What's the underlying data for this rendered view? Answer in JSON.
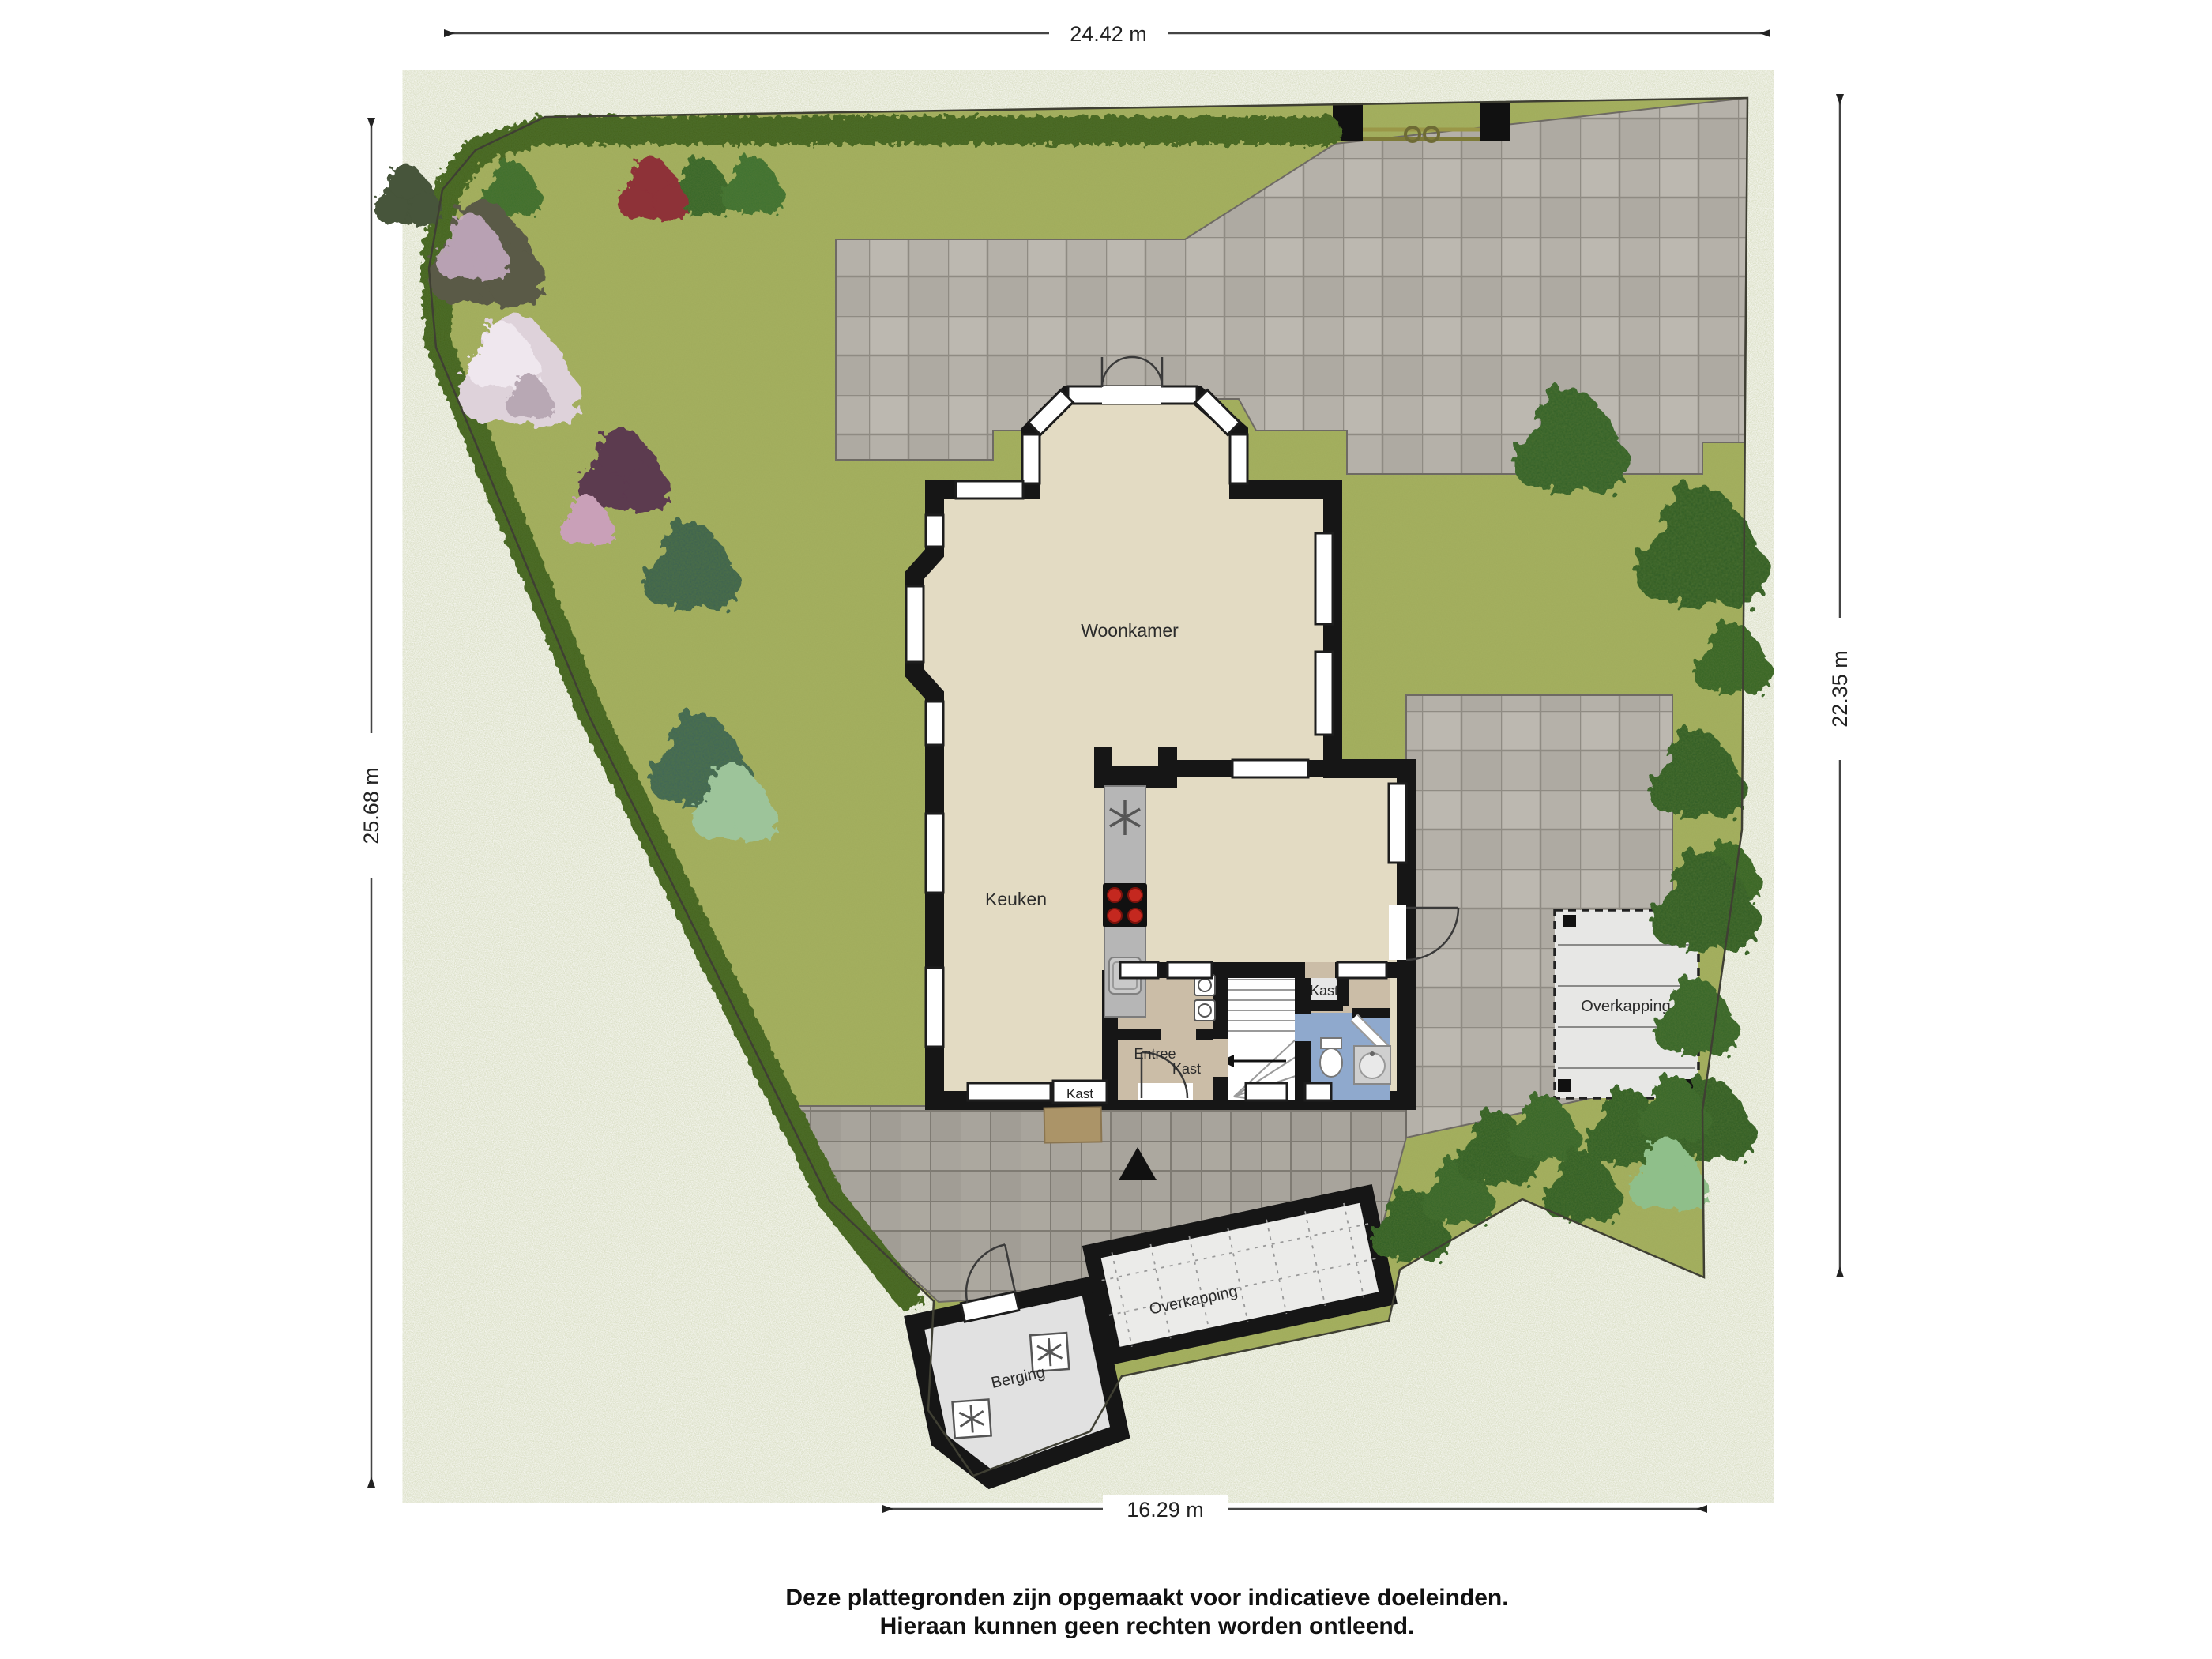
{
  "plan": {
    "title": "Plattegrond tuin met begane grond",
    "dimensions": {
      "top": "24.42 m",
      "left": "25.68 m",
      "right": "22.35 m",
      "bottom": "16.29 m"
    },
    "rooms": {
      "woonkamer": "Woonkamer",
      "keuken": "Keuken",
      "entree": "Entree",
      "kast_wall": "Kast",
      "kast_understairs": "Kast",
      "kast_room": "Kast",
      "berging": "Berging",
      "overkapping_right": "Overkapping",
      "overkapping_south": "Overkapping"
    },
    "disclaimer": [
      "Deze plattegronden zijn opgemaakt voor indicatieve doeleinden.",
      "Hieraan kunnen geen rechten worden ontleend."
    ],
    "colors": {
      "grass": "#a6b15f",
      "hedge": "#45621f",
      "paving": "#b5b1a9",
      "paving_dark": "#a8a49c",
      "floor": "#e3dbc3",
      "wall": "#161616",
      "bath_floor": "#8fa9cd",
      "hall_floor": "#cbbda7",
      "storage_floor": "#e1e1e1",
      "hob_accent": "#c4281f"
    }
  }
}
